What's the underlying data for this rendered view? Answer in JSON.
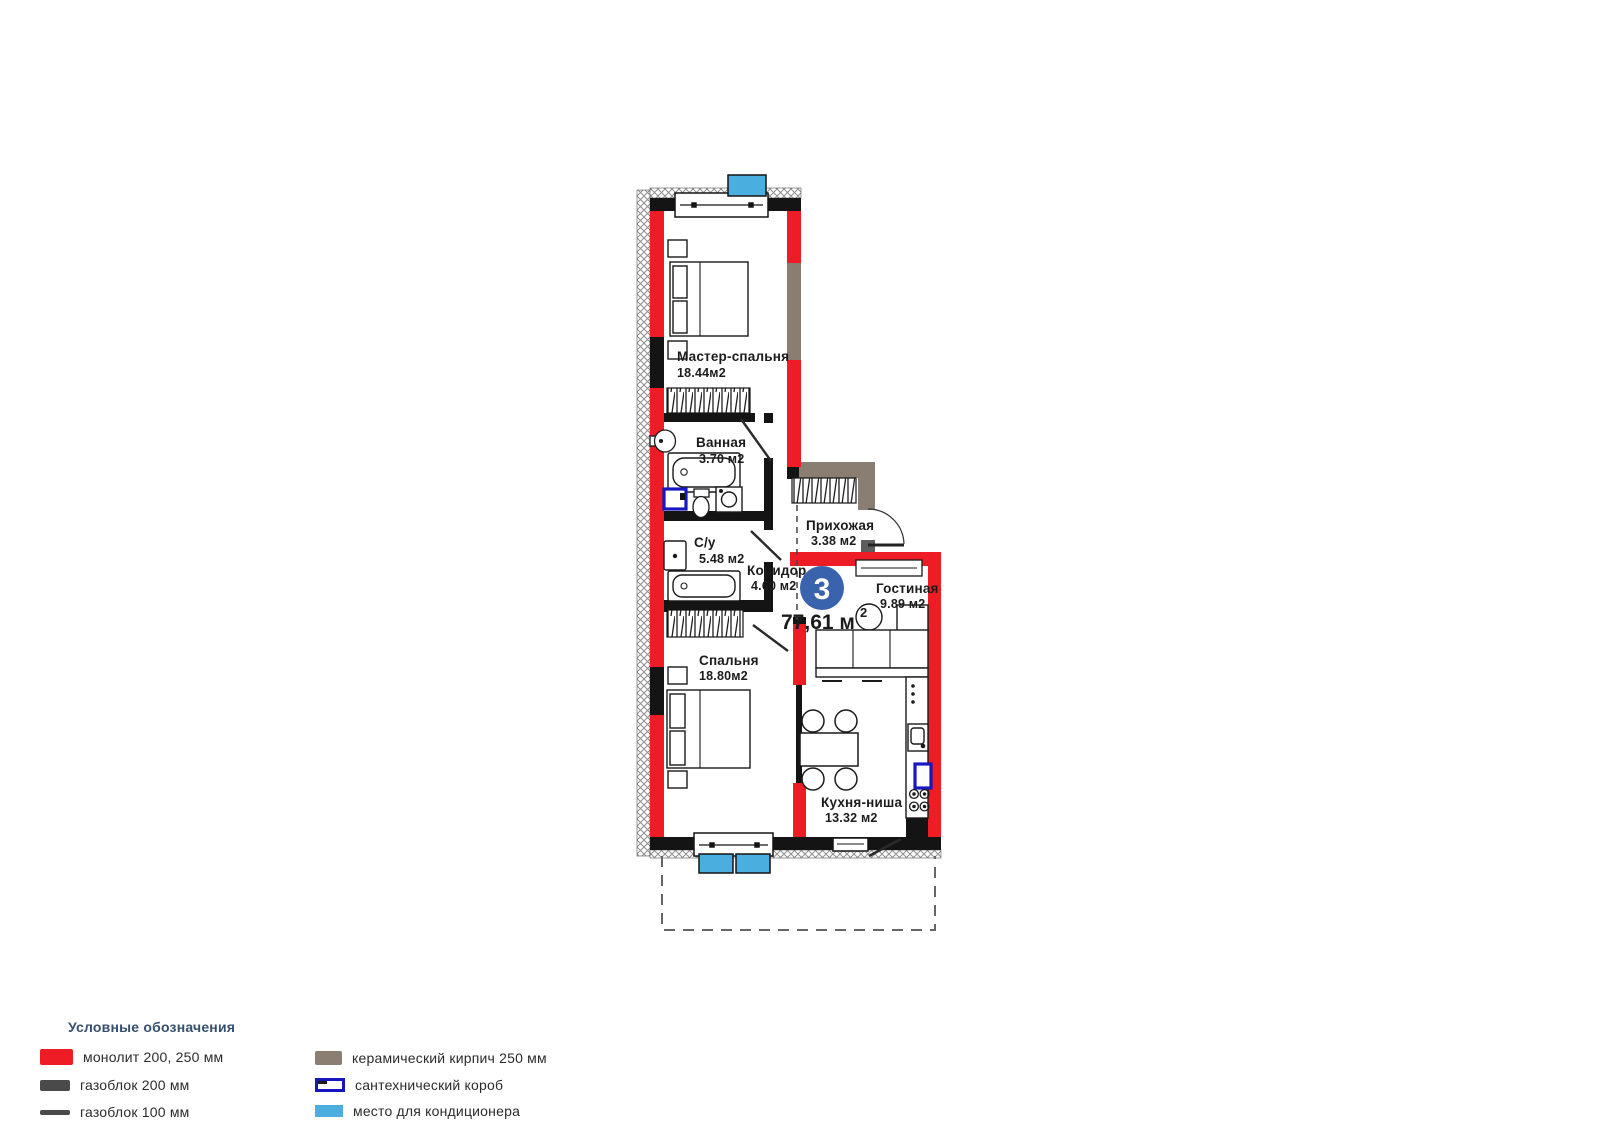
{
  "plan": {
    "badge": {
      "number": "3"
    },
    "total_area": {
      "value": "77,61 м",
      "sup": "2"
    },
    "rooms": [
      {
        "name": "Мастер-спальня",
        "area": "18.44м2"
      },
      {
        "name": "Ванная",
        "area": "3.70 м2"
      },
      {
        "name": "С/у",
        "area": "5.48 м2"
      },
      {
        "name": "Коридор",
        "area": "4.60 м2"
      },
      {
        "name": "Прихожая",
        "area": "3.38 м2"
      },
      {
        "name": "Гостиная",
        "area": "9.89 м2"
      },
      {
        "name": "Спальня",
        "area": "18.80м2"
      },
      {
        "name": "Кухня-ниша",
        "area": "13.32 м2"
      }
    ],
    "icons": [
      "bed-icon",
      "wardrobe-icon",
      "bathtub-icon",
      "sink-icon",
      "toilet-icon",
      "washing-machine-icon",
      "sofa-icon",
      "coffee-table-icon",
      "tv-stand-icon",
      "dining-table-icon",
      "chair-icon",
      "kitchen-counter-icon",
      "kitchen-sink-icon",
      "stove-icon",
      "plumbing-box-icon",
      "ac-unit-icon",
      "window-icon",
      "door-icon"
    ]
  },
  "legend": {
    "title": "Условные обозначения",
    "items": [
      {
        "id": "monolith",
        "label": "монолит 200, 250 мм",
        "color": "#ee1c25"
      },
      {
        "id": "gasblock-200",
        "label": "газоблок 200 мм",
        "color": "#4a4a4a"
      },
      {
        "id": "gasblock-100",
        "label": "газоблок 100 мм",
        "color": "#4a4a4a"
      },
      {
        "id": "ceramic",
        "label": "керамический кирпич 250 мм",
        "color": "#8a7d72"
      },
      {
        "id": "plumbing",
        "label": "сантехнический короб",
        "color": "#1717c0"
      },
      {
        "id": "ac",
        "label": "место для кондиционера",
        "color": "#4aaede"
      }
    ]
  },
  "colors": {
    "wall_monolith": "#ee1c25",
    "wall_gasblock": "#141414",
    "wall_ceramic": "#8a7d72",
    "plumbing_box": "#1717c0",
    "ac_unit": "#4aaede",
    "badge_circle": "#3a63ad",
    "legend_title": "#35506e",
    "text": "#1b1b1b"
  }
}
